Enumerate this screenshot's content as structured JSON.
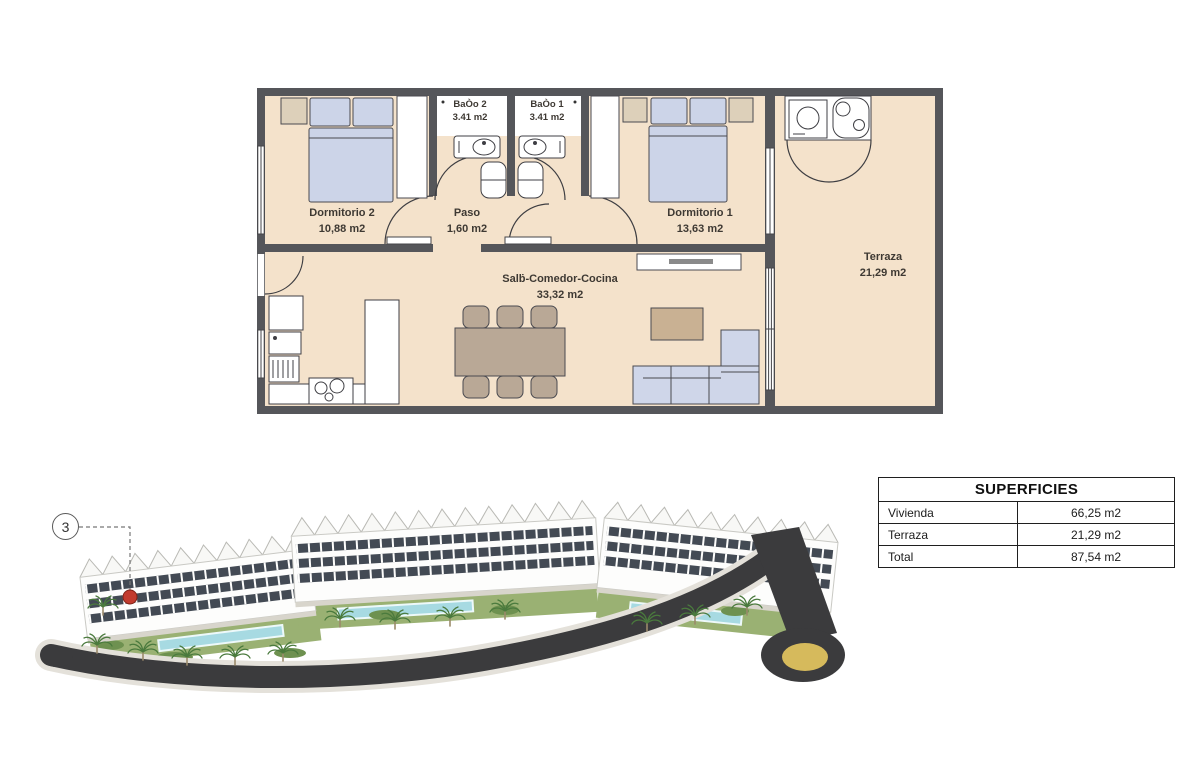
{
  "floor_plan": {
    "rooms": [
      {
        "id": "dormitorio-2",
        "name": "Dormitorio 2",
        "area": "10,88 m2"
      },
      {
        "id": "bano-2",
        "name": "BaÒo 2",
        "area": "3.41 m2"
      },
      {
        "id": "bano-1",
        "name": "BaÒo 1",
        "area": "3.41 m2"
      },
      {
        "id": "paso",
        "name": "Paso",
        "area": "1,60 m2"
      },
      {
        "id": "dormitorio-1",
        "name": "Dormitorio 1",
        "area": "13,63 m2"
      },
      {
        "id": "salon-comedor-cocina",
        "name": "Salḃ-Comedor-Cocina",
        "area": "33,32 m2"
      },
      {
        "id": "terraza",
        "name": "Terraza",
        "area": "21,29 m2"
      }
    ]
  },
  "site_plan": {
    "marker_label": "3"
  },
  "superficies_table": {
    "title": "SUPERFICIES",
    "rows": [
      {
        "label": "Vivienda",
        "value": "66,25 m2"
      },
      {
        "label": "Terraza",
        "value": "21,29 m2"
      },
      {
        "label": "Total",
        "value": "87,54 m2"
      }
    ]
  },
  "colors": {
    "floor": "#f4e2cb",
    "wall": "#55565a",
    "furniture_blue": "#ccd4e8",
    "wood": "#b9a896",
    "pool": "#a7dae2",
    "greenery": "#9ab173",
    "road": "#3b3b3d",
    "roundabout_gold": "#d6ba5c",
    "marker_red": "#c23b2e"
  }
}
